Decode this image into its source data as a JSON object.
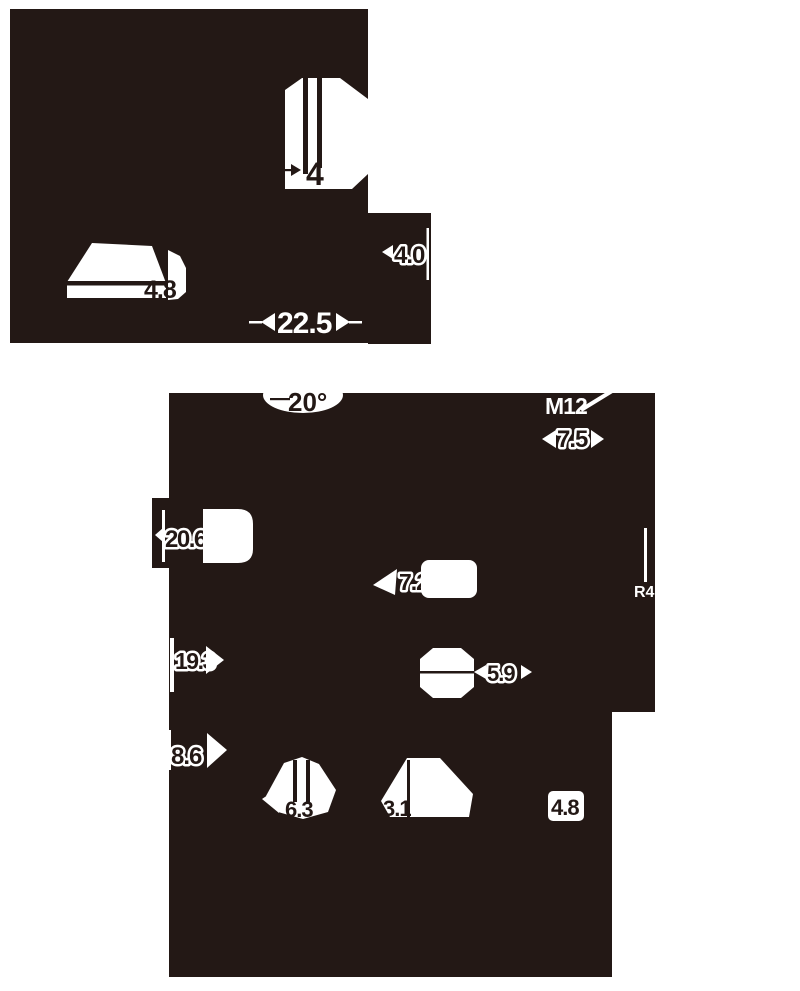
{
  "drawing": {
    "ink_color": "#231815",
    "paper_color": "#ffffff",
    "labels": {
      "slot_4": "4",
      "height_4_8_top": "4.8",
      "width_22_5": "22.5",
      "depth_4_0": "4.0",
      "angle_20": "20°",
      "thread_m12": "M12",
      "length_7_5": "7.5",
      "dia_20_6": "20.6",
      "dia_7_2": "7.2",
      "radius_r4": "R4",
      "dia_19_3": "19.3",
      "width_5_9": "5.9",
      "dia_8_6": "8.6",
      "width_6_3": "6.3",
      "width_3_1": "3.1",
      "thick_4_8_bottom": "4.8"
    }
  }
}
